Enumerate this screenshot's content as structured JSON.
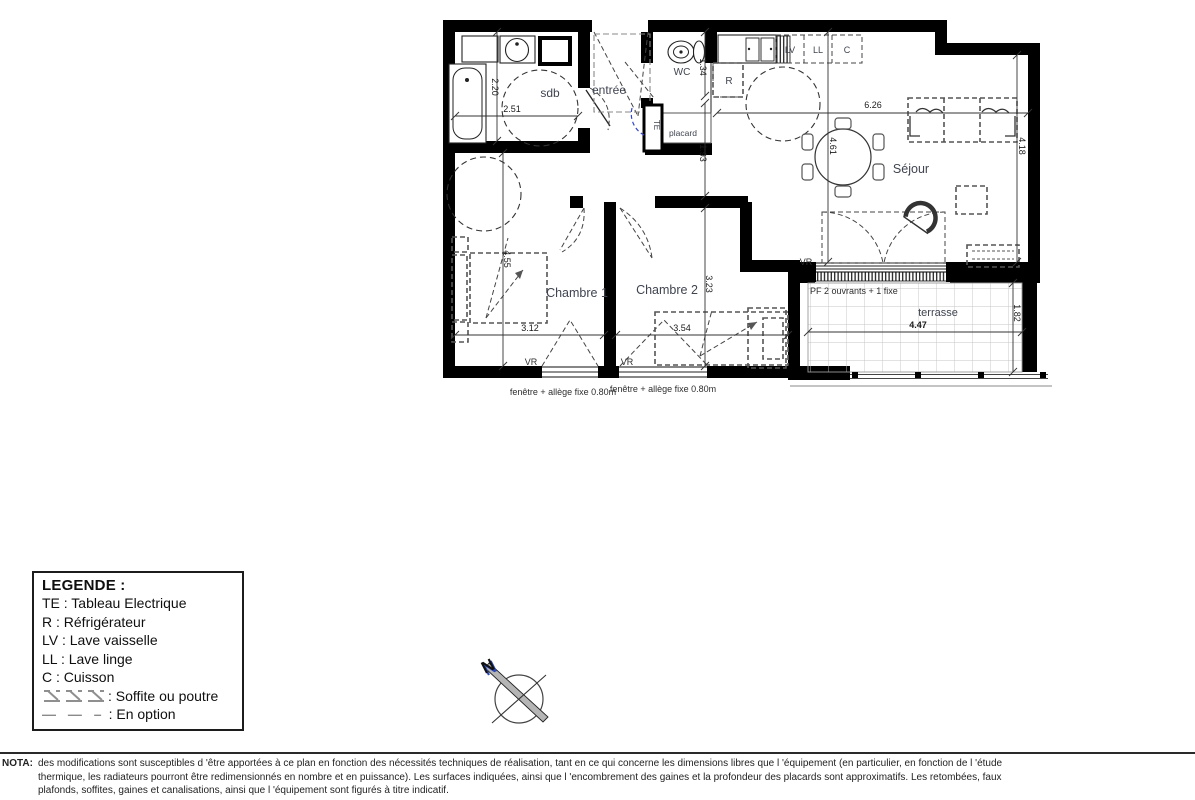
{
  "plan": {
    "rooms": {
      "sdb": "sdb",
      "entree": "entrée",
      "wc": "WC",
      "placard": "placard",
      "sejour": "Séjour",
      "chambre1": "Chambre 1",
      "chambre2": "Chambre 2",
      "terrasse": "terrasse"
    },
    "appliances": {
      "te": "TE",
      "r": "R",
      "lv": "LV",
      "ll": "LL",
      "c": "C"
    },
    "dims": {
      "sdb_w": "2.51",
      "sdb_h": "2.20",
      "wc_h": "1.34",
      "hall_h": "1.93",
      "sejour_w": "6.26",
      "sejour_h1": "4.61",
      "sejour_h2": "4.18",
      "ch1_w": "3.12",
      "ch1_h": "4.55",
      "ch2_w": "3.54",
      "ch2_h": "3.23",
      "terrasse_w": "4.47",
      "terrasse_d": "1.82"
    },
    "annotations": {
      "vr": "VR",
      "pf": "PF 2 ouvrants + 1 fixe",
      "fenetre": "fenêtre + allège fixe 0.80m"
    },
    "compass_n": "N",
    "colors": {
      "wall": "#000000",
      "label": "#3f4450",
      "te_blue": "#3344cc"
    }
  },
  "legend": {
    "title": "LEGENDE :",
    "items": [
      "TE : Tableau Electrique",
      "R : Réfrigérateur",
      "LV : Lave vaisselle",
      "LL : Lave linge",
      "C : Cuisson"
    ],
    "soffite_label": ": Soffite ou poutre",
    "option_label": ": En option",
    "option_symbol": "— — –"
  },
  "nota": {
    "label": "NOTA:",
    "line1": "des modifications sont susceptibles d 'être apportées à ce plan en fonction des nécessités techniques de réalisation, tant en ce qui concerne les dimensions libres que l  'équipement (en particulier, en fonction de l 'étude",
    "line2": "thermique, les radiateurs pourront être redimensionnés en nombre et en puissance). Les surfaces indiquées, ainsi que l  'encombrement des gaines et la profondeur des placards sont approximatifs. Les retombées, faux",
    "line3": "plafonds, soffites, gaines et canalisations, ainsi que l 'équipement sont figurés à titre indicatif."
  }
}
